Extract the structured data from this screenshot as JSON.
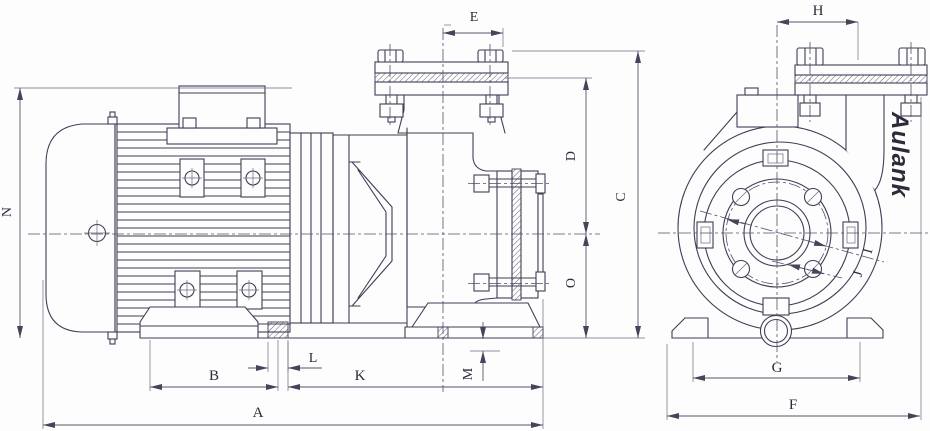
{
  "brand": "Aulank",
  "dims": {
    "a": "A",
    "b": "B",
    "c": "C",
    "d": "D",
    "e": "E",
    "f": "F",
    "g": "G",
    "h": "H",
    "i": "I",
    "j": "J",
    "k": "K",
    "l": "L",
    "m": "M",
    "n": "N",
    "o": "O"
  }
}
